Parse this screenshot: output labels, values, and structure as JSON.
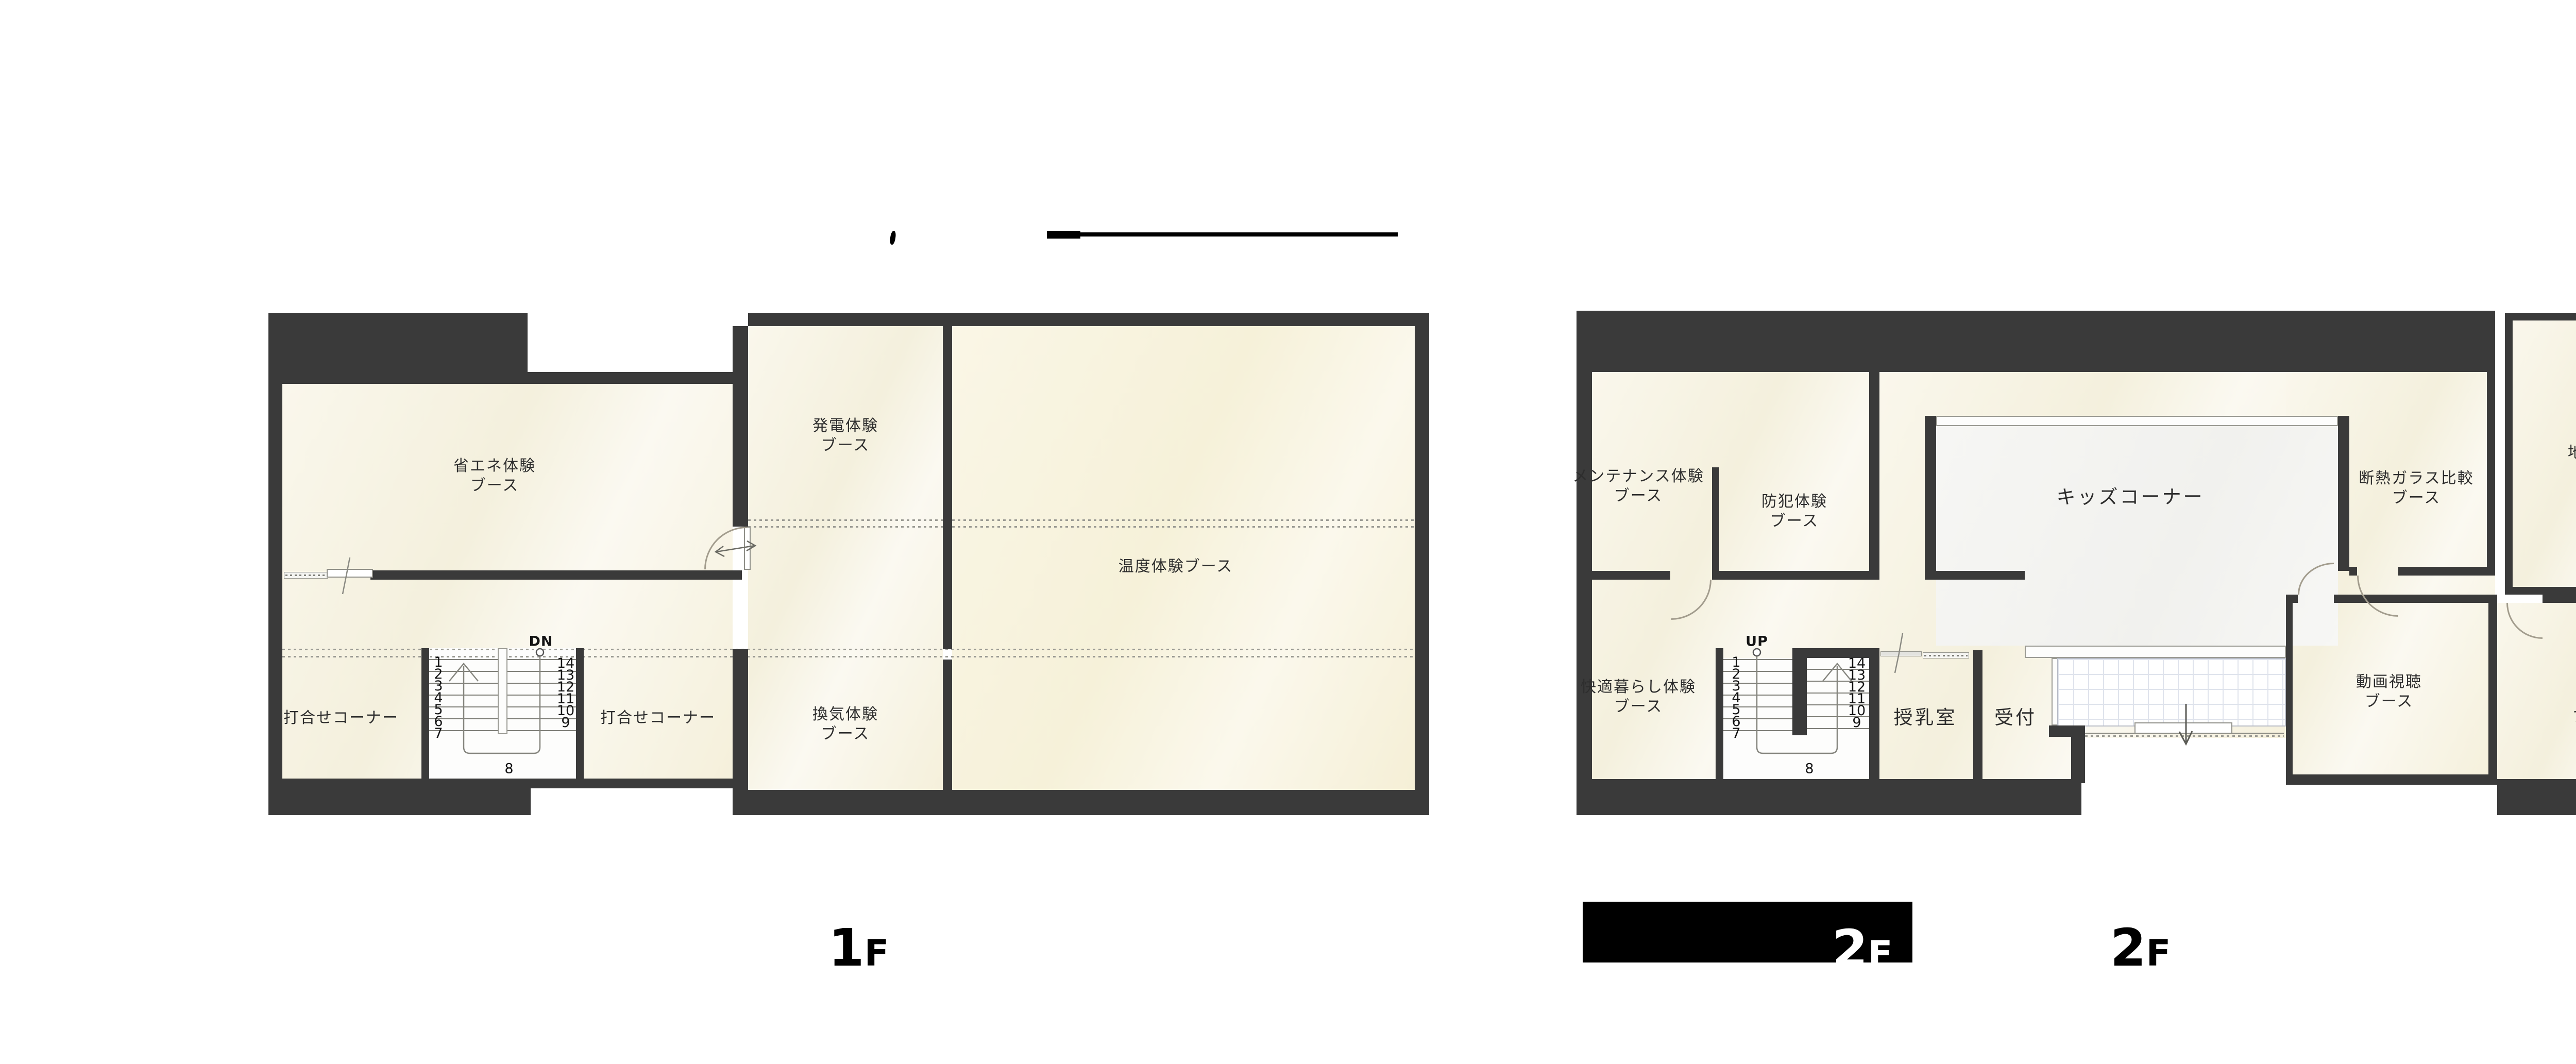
{
  "colors": {
    "wall": "#3a3a3a",
    "floor_cream": "#f8f5e8",
    "floor_warm": "#f7f2dc",
    "floor_light": "#f4f4f1",
    "tile_line": "#dfe3ec",
    "redaction_bar": "#000000",
    "text": "#2d2d2d"
  },
  "floor1": {
    "name_digit": "1",
    "name_suffix": "F",
    "rooms": {
      "shoene": "省エネ体験\nブース",
      "hatsuden": "発電体験\nブース",
      "ondo": "温度体験ブース",
      "uchiawase_left": "打合せコーナー",
      "uchiawase_right": "打合せコーナー",
      "kanki": "換気体験\nブース"
    },
    "stairs": {
      "direction_label": "DN",
      "left_numbers": [
        "1",
        "2",
        "3",
        "4",
        "5",
        "6",
        "7"
      ],
      "right_numbers": [
        "14",
        "13",
        "12",
        "11",
        "10",
        "9"
      ],
      "landing_number": "8"
    }
  },
  "floor2": {
    "name_digit": "2",
    "name_suffix": "F",
    "bar_digit": "2",
    "bar_suffix": "F",
    "rooms": {
      "maintenance": "メンテナンス体験\nブース",
      "bohan": "防犯体験\nブース",
      "kids": "キッズコーナー",
      "dannetsu": "断熱ガラス比較\nブース",
      "jishin": "地震体験\nブース",
      "kaiteki": "快適暮らし体験\nブース",
      "doga": "動画視聴\nブース",
      "kozo": "構造\nブース",
      "junyu": "授乳室",
      "uketsuke": "受付"
    },
    "stairs": {
      "direction_label": "UP",
      "left_numbers": [
        "1",
        "2",
        "3",
        "4",
        "5",
        "6",
        "7"
      ],
      "right_numbers": [
        "14",
        "13",
        "12",
        "11",
        "10",
        "9"
      ],
      "landing_number": "8"
    }
  }
}
